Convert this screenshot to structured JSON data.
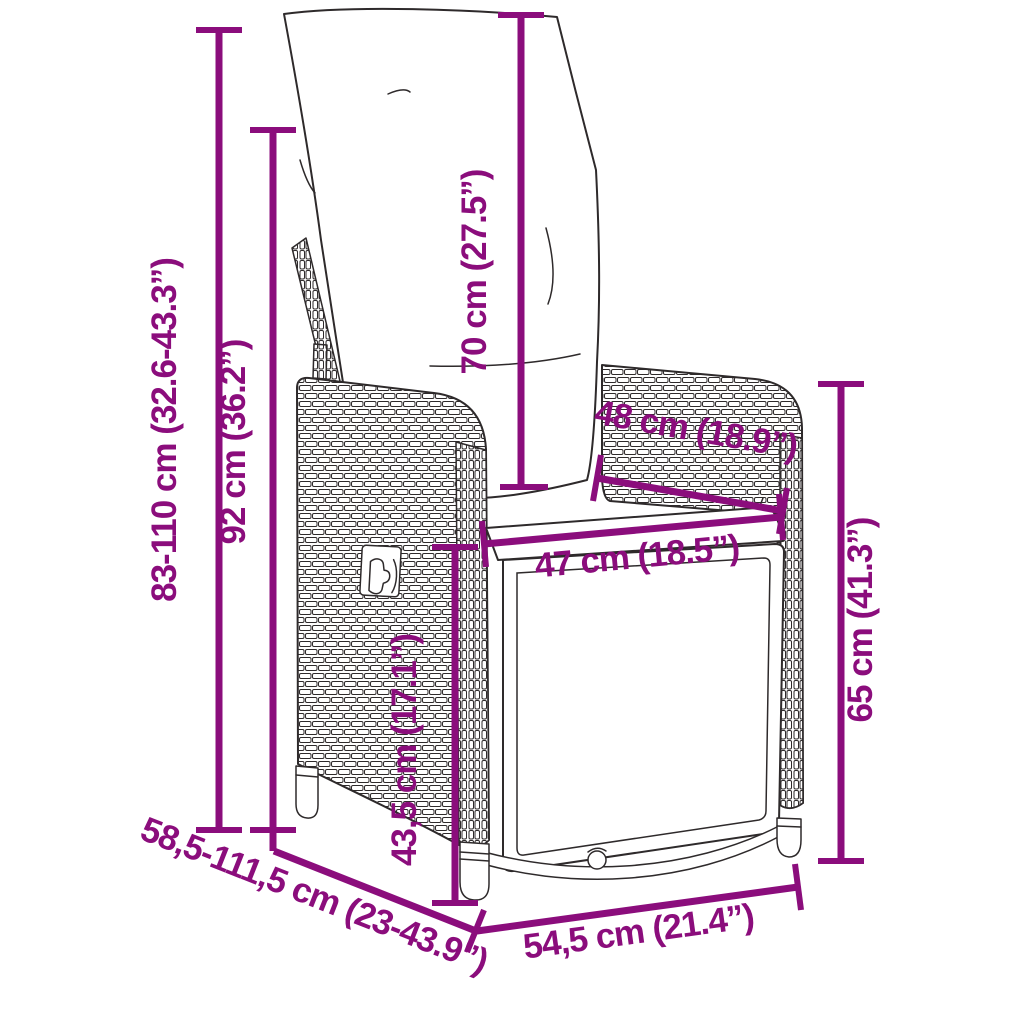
{
  "diagram": {
    "accent_color": "#8B0D7C",
    "line_color": "#2E2A2B",
    "background_color": "#FFFFFF",
    "measurements": {
      "height_range": {
        "label": "83-110 cm (32.6-43.3”)"
      },
      "back_height": {
        "label": "92 cm (36.2”)"
      },
      "cushion_height": {
        "label": "70 cm (27.5”)"
      },
      "armrest_depth": {
        "label": "48 cm (18.9”)"
      },
      "seat_width": {
        "label": "47 cm (18.5”)"
      },
      "side_height": {
        "label": "65 cm (41.3”)"
      },
      "seat_height": {
        "label": "43,5 cm (17.1”)"
      },
      "depth_range": {
        "label": "58,5-111,5 cm (23-43.9”)"
      },
      "base_width": {
        "label": "54,5 cm (21.4”)"
      }
    }
  }
}
